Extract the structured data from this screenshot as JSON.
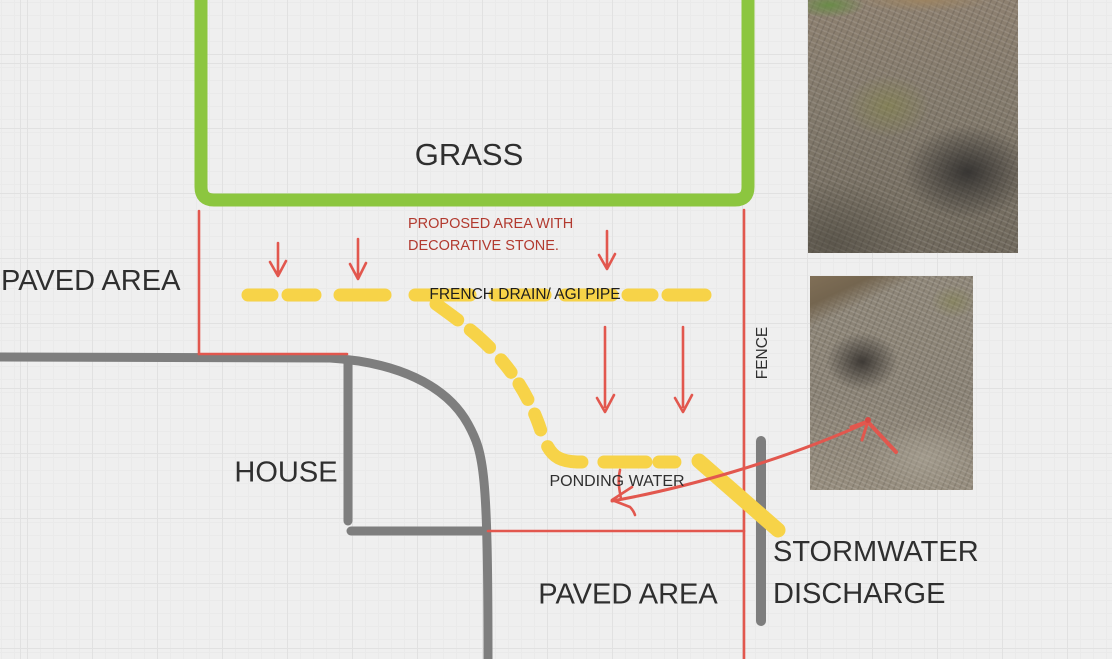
{
  "labels": {
    "grass": "GRASS",
    "paved_area_left": "PAVED AREA",
    "paved_area_bottom": "PAVED AREA",
    "house": "HOUSE",
    "stormwater_line1": "STORMWATER",
    "stormwater_line2": "DISCHARGE",
    "fence": "FENCE",
    "french_drain": "FRENCH DRAIN/ AGI PIPE",
    "ponding_water": "PONDING WATER",
    "proposed_line1": "PROPOSED AREA WITH",
    "proposed_line2": "DECORATIVE STONE."
  },
  "colors": {
    "background": "#efefef",
    "grid_major": "#e1e1e1",
    "grid_minor": "#eaeaea",
    "grass_border_green": "#8cc63f",
    "boundary_red": "#e2574e",
    "annotation_text_red": "#b23a2f",
    "drain_yellow": "#f7d348",
    "structure_gray": "#7e7e7e",
    "text_dark": "#2f2f2f"
  },
  "photos": [
    {
      "name": "site-photo-top",
      "description": "gravel ground, moss patch, dark wet area"
    },
    {
      "name": "site-photo-bottom",
      "description": "gravel ground with dark wet depression"
    }
  ]
}
